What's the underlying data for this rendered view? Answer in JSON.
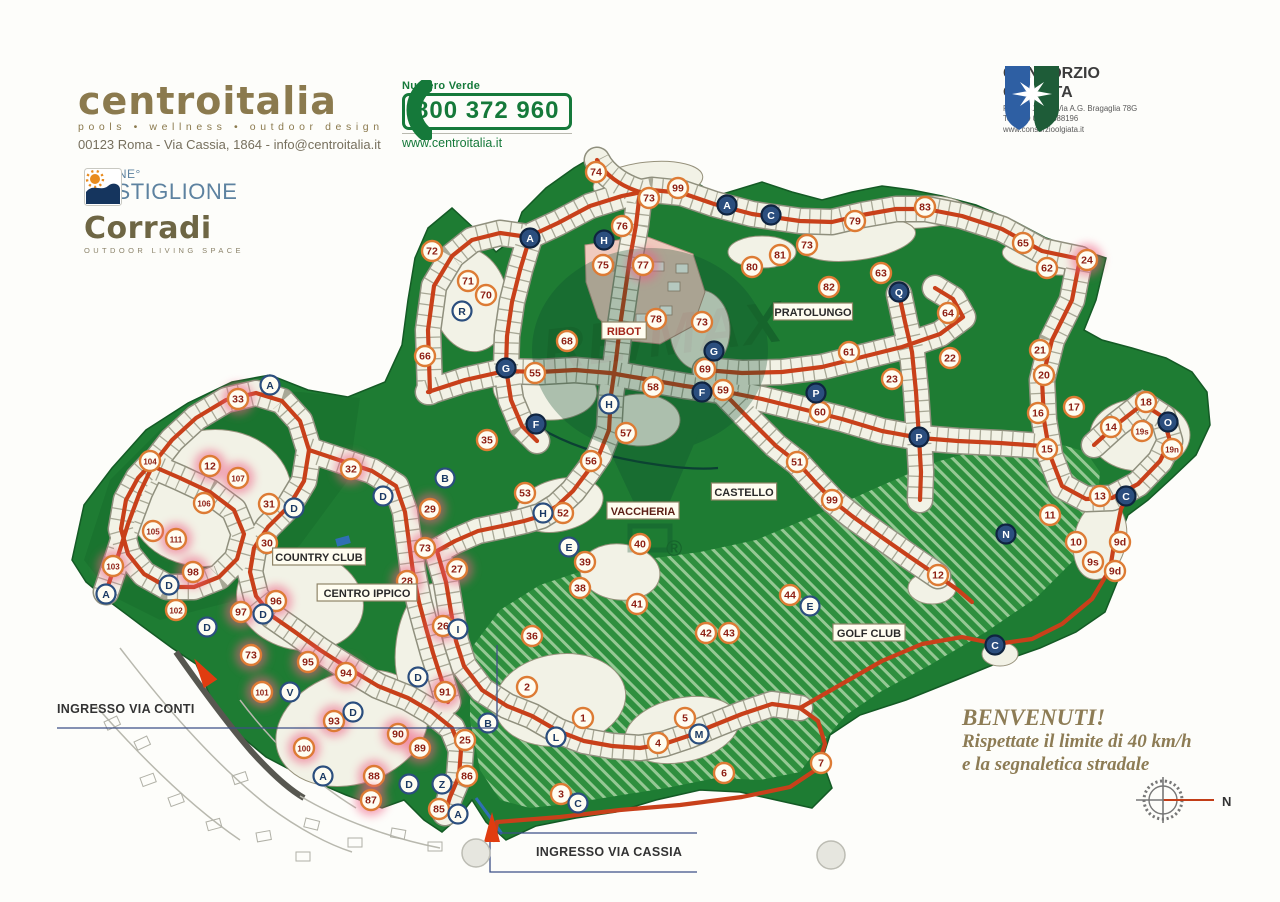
{
  "header": {
    "centroitalia": {
      "name": "centroitalia",
      "tagline": "pools • wellness • outdoor design",
      "address": "00123 Roma - Via Cassia, 1864 - info@centroitalia.it"
    },
    "numero_verde": {
      "label": "Numero Verde",
      "phone": "800 372 960",
      "website": "www.centroitalia.it"
    },
    "consorzio": {
      "line1": "CONSORZIO",
      "line2": "OLGIATA",
      "address": "ROMA, 00123, Via A.G. Bragaglia 78G",
      "tel": "Tel: +39 06 30888196",
      "website": "www.consorzioolgiata.it"
    }
  },
  "sponsors": {
    "piscine": {
      "line1": "PISCINE°",
      "line2": "CASTIGLIONE"
    },
    "corradi": {
      "name": "Corradi",
      "tagline": "OUTDOOR LIVING SPACE"
    }
  },
  "map": {
    "region_labels": [
      {
        "text": "RIBOT",
        "x": 624,
        "y": 331,
        "color": "#a3261a"
      },
      {
        "text": "PRATOLUNGO",
        "x": 813,
        "y": 312,
        "color": "#2a2a2a"
      },
      {
        "text": "CASTELLO",
        "x": 744,
        "y": 492,
        "color": "#2a2a2a"
      },
      {
        "text": "VACCHERIA",
        "x": 643,
        "y": 511,
        "color": "#5c1f16"
      },
      {
        "text": "COUNTRY CLUB",
        "x": 319,
        "y": 557,
        "color": "#2a2a2a"
      },
      {
        "text": "CENTRO IPPICO",
        "x": 367,
        "y": 593,
        "color": "#2a2a2a"
      },
      {
        "text": "GOLF CLUB",
        "x": 869,
        "y": 633,
        "color": "#2a2a2a"
      }
    ],
    "markers": [
      {
        "t": "74",
        "x": 596,
        "y": 172,
        "k": "n"
      },
      {
        "t": "73",
        "x": 649,
        "y": 198,
        "k": "n"
      },
      {
        "t": "99",
        "x": 678,
        "y": 188,
        "k": "n"
      },
      {
        "t": "76",
        "x": 622,
        "y": 226,
        "k": "n"
      },
      {
        "t": "75",
        "x": 603,
        "y": 265,
        "k": "n"
      },
      {
        "t": "77",
        "x": 643,
        "y": 265,
        "k": "n",
        "hl": 1
      },
      {
        "t": "78",
        "x": 656,
        "y": 319,
        "k": "n"
      },
      {
        "t": "73",
        "x": 702,
        "y": 322,
        "k": "n"
      },
      {
        "t": "80",
        "x": 752,
        "y": 267,
        "k": "n"
      },
      {
        "t": "81",
        "x": 780,
        "y": 255,
        "k": "n"
      },
      {
        "t": "82",
        "x": 829,
        "y": 287,
        "k": "n"
      },
      {
        "t": "79",
        "x": 855,
        "y": 221,
        "k": "n"
      },
      {
        "t": "73",
        "x": 807,
        "y": 245,
        "k": "n"
      },
      {
        "t": "83",
        "x": 925,
        "y": 207,
        "k": "n"
      },
      {
        "t": "63",
        "x": 881,
        "y": 273,
        "k": "n"
      },
      {
        "t": "65",
        "x": 1023,
        "y": 243,
        "k": "n"
      },
      {
        "t": "62",
        "x": 1047,
        "y": 268,
        "k": "n"
      },
      {
        "t": "24",
        "x": 1087,
        "y": 260,
        "k": "n",
        "hl": 1
      },
      {
        "t": "64",
        "x": 948,
        "y": 313,
        "k": "n"
      },
      {
        "t": "61",
        "x": 849,
        "y": 352,
        "k": "n"
      },
      {
        "t": "22",
        "x": 950,
        "y": 358,
        "k": "n"
      },
      {
        "t": "23",
        "x": 892,
        "y": 379,
        "k": "n"
      },
      {
        "t": "21",
        "x": 1040,
        "y": 350,
        "k": "n"
      },
      {
        "t": "20",
        "x": 1044,
        "y": 375,
        "k": "n"
      },
      {
        "t": "60",
        "x": 820,
        "y": 412,
        "k": "n"
      },
      {
        "t": "51",
        "x": 797,
        "y": 462,
        "k": "n"
      },
      {
        "t": "99",
        "x": 832,
        "y": 500,
        "k": "n"
      },
      {
        "t": "72",
        "x": 432,
        "y": 251,
        "k": "n"
      },
      {
        "t": "71",
        "x": 468,
        "y": 281,
        "k": "n"
      },
      {
        "t": "70",
        "x": 486,
        "y": 295,
        "k": "n"
      },
      {
        "t": "66",
        "x": 425,
        "y": 356,
        "k": "n"
      },
      {
        "t": "55",
        "x": 535,
        "y": 373,
        "k": "n"
      },
      {
        "t": "68",
        "x": 567,
        "y": 341,
        "k": "n"
      },
      {
        "t": "69",
        "x": 705,
        "y": 369,
        "k": "n"
      },
      {
        "t": "58",
        "x": 653,
        "y": 387,
        "k": "n"
      },
      {
        "t": "59",
        "x": 723,
        "y": 390,
        "k": "n"
      },
      {
        "t": "57",
        "x": 626,
        "y": 433,
        "k": "n"
      },
      {
        "t": "56",
        "x": 591,
        "y": 461,
        "k": "n"
      },
      {
        "t": "53",
        "x": 525,
        "y": 493,
        "k": "n"
      },
      {
        "t": "52",
        "x": 563,
        "y": 513,
        "k": "n"
      },
      {
        "t": "35",
        "x": 487,
        "y": 440,
        "k": "n"
      },
      {
        "t": "40",
        "x": 640,
        "y": 544,
        "k": "n"
      },
      {
        "t": "39",
        "x": 585,
        "y": 562,
        "k": "n"
      },
      {
        "t": "38",
        "x": 580,
        "y": 588,
        "k": "n"
      },
      {
        "t": "41",
        "x": 637,
        "y": 604,
        "k": "n"
      },
      {
        "t": "42",
        "x": 706,
        "y": 633,
        "k": "n"
      },
      {
        "t": "43",
        "x": 729,
        "y": 633,
        "k": "n"
      },
      {
        "t": "44",
        "x": 790,
        "y": 595,
        "k": "n"
      },
      {
        "t": "12",
        "x": 938,
        "y": 575,
        "k": "n"
      },
      {
        "t": "33",
        "x": 238,
        "y": 399,
        "k": "n",
        "hl": 1
      },
      {
        "t": "104",
        "x": 150,
        "y": 461,
        "k": "n"
      },
      {
        "t": "12",
        "x": 210,
        "y": 466,
        "k": "n",
        "hl": 1
      },
      {
        "t": "107",
        "x": 238,
        "y": 478,
        "k": "n",
        "hl": 1
      },
      {
        "t": "106",
        "x": 204,
        "y": 503,
        "k": "n"
      },
      {
        "t": "31",
        "x": 269,
        "y": 504,
        "k": "n"
      },
      {
        "t": "32",
        "x": 351,
        "y": 469,
        "k": "n",
        "hl": 1
      },
      {
        "t": "105",
        "x": 153,
        "y": 531,
        "k": "n"
      },
      {
        "t": "111",
        "x": 176,
        "y": 539,
        "k": "n",
        "hl": 1
      },
      {
        "t": "30",
        "x": 267,
        "y": 543,
        "k": "n"
      },
      {
        "t": "98",
        "x": 193,
        "y": 572,
        "k": "n",
        "hl": 1
      },
      {
        "t": "103",
        "x": 113,
        "y": 566,
        "k": "n",
        "hl": 1
      },
      {
        "t": "102",
        "x": 176,
        "y": 610,
        "k": "n"
      },
      {
        "t": "97",
        "x": 241,
        "y": 612,
        "k": "n",
        "hl": 1
      },
      {
        "t": "96",
        "x": 276,
        "y": 601,
        "k": "n",
        "hl": 1
      },
      {
        "t": "29",
        "x": 430,
        "y": 509,
        "k": "n",
        "hl": 1
      },
      {
        "t": "73",
        "x": 425,
        "y": 548,
        "k": "n",
        "hl": 1
      },
      {
        "t": "28",
        "x": 407,
        "y": 581,
        "k": "n",
        "hl": 1
      },
      {
        "t": "27",
        "x": 457,
        "y": 569,
        "k": "n",
        "hl": 1
      },
      {
        "t": "26",
        "x": 443,
        "y": 626,
        "k": "n",
        "hl": 1
      },
      {
        "t": "36",
        "x": 532,
        "y": 636,
        "k": "n"
      },
      {
        "t": "73",
        "x": 251,
        "y": 655,
        "k": "n",
        "hl": 1
      },
      {
        "t": "95",
        "x": 308,
        "y": 662,
        "k": "n",
        "hl": 1
      },
      {
        "t": "94",
        "x": 346,
        "y": 673,
        "k": "n",
        "hl": 1
      },
      {
        "t": "101",
        "x": 262,
        "y": 692,
        "k": "n",
        "hl": 1
      },
      {
        "t": "93",
        "x": 334,
        "y": 721,
        "k": "n",
        "hl": 1
      },
      {
        "t": "100",
        "x": 304,
        "y": 748,
        "k": "n",
        "hl": 1
      },
      {
        "t": "90",
        "x": 398,
        "y": 734,
        "k": "n",
        "hl": 1
      },
      {
        "t": "89",
        "x": 420,
        "y": 748,
        "k": "n",
        "hl": 1
      },
      {
        "t": "88",
        "x": 374,
        "y": 776,
        "k": "n",
        "hl": 1
      },
      {
        "t": "87",
        "x": 371,
        "y": 800,
        "k": "n",
        "hl": 1
      },
      {
        "t": "91",
        "x": 445,
        "y": 692,
        "k": "n",
        "hl": 1
      },
      {
        "t": "25",
        "x": 465,
        "y": 740,
        "k": "n"
      },
      {
        "t": "86",
        "x": 467,
        "y": 776,
        "k": "n"
      },
      {
        "t": "85",
        "x": 439,
        "y": 809,
        "k": "n"
      },
      {
        "t": "2",
        "x": 527,
        "y": 687,
        "k": "n"
      },
      {
        "t": "1",
        "x": 583,
        "y": 718,
        "k": "n"
      },
      {
        "t": "5",
        "x": 685,
        "y": 718,
        "k": "n"
      },
      {
        "t": "4",
        "x": 658,
        "y": 743,
        "k": "n"
      },
      {
        "t": "6",
        "x": 724,
        "y": 773,
        "k": "n"
      },
      {
        "t": "3",
        "x": 561,
        "y": 794,
        "k": "n"
      },
      {
        "t": "7",
        "x": 821,
        "y": 763,
        "k": "n"
      },
      {
        "t": "18",
        "x": 1146,
        "y": 402,
        "k": "n"
      },
      {
        "t": "17",
        "x": 1074,
        "y": 407,
        "k": "n"
      },
      {
        "t": "16",
        "x": 1038,
        "y": 413,
        "k": "n"
      },
      {
        "t": "14",
        "x": 1111,
        "y": 427,
        "k": "n"
      },
      {
        "t": "19s",
        "x": 1142,
        "y": 431,
        "k": "n"
      },
      {
        "t": "19n",
        "x": 1172,
        "y": 449,
        "k": "n"
      },
      {
        "t": "15",
        "x": 1047,
        "y": 449,
        "k": "n"
      },
      {
        "t": "13",
        "x": 1100,
        "y": 496,
        "k": "n"
      },
      {
        "t": "11",
        "x": 1050,
        "y": 515,
        "k": "n"
      },
      {
        "t": "10",
        "x": 1076,
        "y": 542,
        "k": "n"
      },
      {
        "t": "9d",
        "x": 1120,
        "y": 542,
        "k": "n"
      },
      {
        "t": "9s",
        "x": 1093,
        "y": 562,
        "k": "n"
      },
      {
        "t": "9d",
        "x": 1115,
        "y": 571,
        "k": "n"
      },
      {
        "t": "A",
        "x": 727,
        "y": 205,
        "k": "l",
        "dark": 1
      },
      {
        "t": "C",
        "x": 771,
        "y": 215,
        "k": "l",
        "dark": 1
      },
      {
        "t": "H",
        "x": 604,
        "y": 240,
        "k": "l",
        "dark": 1
      },
      {
        "t": "A",
        "x": 530,
        "y": 238,
        "k": "l",
        "dark": 1
      },
      {
        "t": "Q",
        "x": 899,
        "y": 292,
        "k": "l",
        "dark": 1
      },
      {
        "t": "G",
        "x": 714,
        "y": 351,
        "k": "l",
        "dark": 1
      },
      {
        "t": "G",
        "x": 506,
        "y": 368,
        "k": "l",
        "dark": 1
      },
      {
        "t": "F",
        "x": 536,
        "y": 424,
        "k": "l",
        "dark": 1
      },
      {
        "t": "F",
        "x": 702,
        "y": 392,
        "k": "l",
        "dark": 1
      },
      {
        "t": "P",
        "x": 816,
        "y": 393,
        "k": "l",
        "dark": 1
      },
      {
        "t": "P",
        "x": 919,
        "y": 437,
        "k": "l",
        "dark": 1
      },
      {
        "t": "O",
        "x": 1168,
        "y": 422,
        "k": "l",
        "dark": 1
      },
      {
        "t": "N",
        "x": 1006,
        "y": 534,
        "k": "l",
        "dark": 1
      },
      {
        "t": "C",
        "x": 1126,
        "y": 496,
        "k": "l",
        "dark": 1
      },
      {
        "t": "C",
        "x": 995,
        "y": 645,
        "k": "l",
        "dark": 1
      },
      {
        "t": "E",
        "x": 569,
        "y": 547,
        "k": "l"
      },
      {
        "t": "E",
        "x": 810,
        "y": 606,
        "k": "l"
      },
      {
        "t": "H",
        "x": 609,
        "y": 404,
        "k": "l"
      },
      {
        "t": "H",
        "x": 543,
        "y": 513,
        "k": "l"
      },
      {
        "t": "B",
        "x": 445,
        "y": 478,
        "k": "l"
      },
      {
        "t": "B",
        "x": 488,
        "y": 723,
        "k": "l"
      },
      {
        "t": "R",
        "x": 462,
        "y": 311,
        "k": "l"
      },
      {
        "t": "D",
        "x": 294,
        "y": 508,
        "k": "l"
      },
      {
        "t": "D",
        "x": 383,
        "y": 496,
        "k": "l"
      },
      {
        "t": "D",
        "x": 169,
        "y": 585,
        "k": "l"
      },
      {
        "t": "D",
        "x": 263,
        "y": 614,
        "k": "l"
      },
      {
        "t": "D",
        "x": 207,
        "y": 627,
        "k": "l"
      },
      {
        "t": "D",
        "x": 418,
        "y": 677,
        "k": "l"
      },
      {
        "t": "D",
        "x": 353,
        "y": 712,
        "k": "l"
      },
      {
        "t": "D",
        "x": 409,
        "y": 784,
        "k": "l"
      },
      {
        "t": "V",
        "x": 290,
        "y": 692,
        "k": "l"
      },
      {
        "t": "I",
        "x": 458,
        "y": 629,
        "k": "l"
      },
      {
        "t": "L",
        "x": 556,
        "y": 737,
        "k": "l"
      },
      {
        "t": "M",
        "x": 699,
        "y": 734,
        "k": "l"
      },
      {
        "t": "Z",
        "x": 442,
        "y": 784,
        "k": "l"
      },
      {
        "t": "A",
        "x": 106,
        "y": 594,
        "k": "l"
      },
      {
        "t": "A",
        "x": 270,
        "y": 385,
        "k": "l"
      },
      {
        "t": "A",
        "x": 323,
        "y": 776,
        "k": "l"
      },
      {
        "t": "A",
        "x": 458,
        "y": 814,
        "k": "l"
      },
      {
        "t": "C",
        "x": 578,
        "y": 803,
        "k": "l"
      }
    ],
    "entrances": [
      {
        "text": "INGRESSO VIA CONTI"
      },
      {
        "text": "INGRESSO VIA CASSIA"
      }
    ],
    "welcome": {
      "line1": "BENVENUTI!",
      "line2": "Rispettate il limite di 40 km/h",
      "line3": "e la segnaletica stradale"
    },
    "compass": {
      "label": "N"
    },
    "watermark": {
      "text": "RE/MAX",
      "reg": "®"
    }
  },
  "palette": {
    "map_green": "#1e7c33",
    "road": "#c8401a",
    "highlight": "#ee5d84",
    "parcel": "#f2f2e6",
    "brand_gold": "#8b7a4e",
    "brand_green": "#15793a",
    "navy": "#2b4e7e"
  }
}
